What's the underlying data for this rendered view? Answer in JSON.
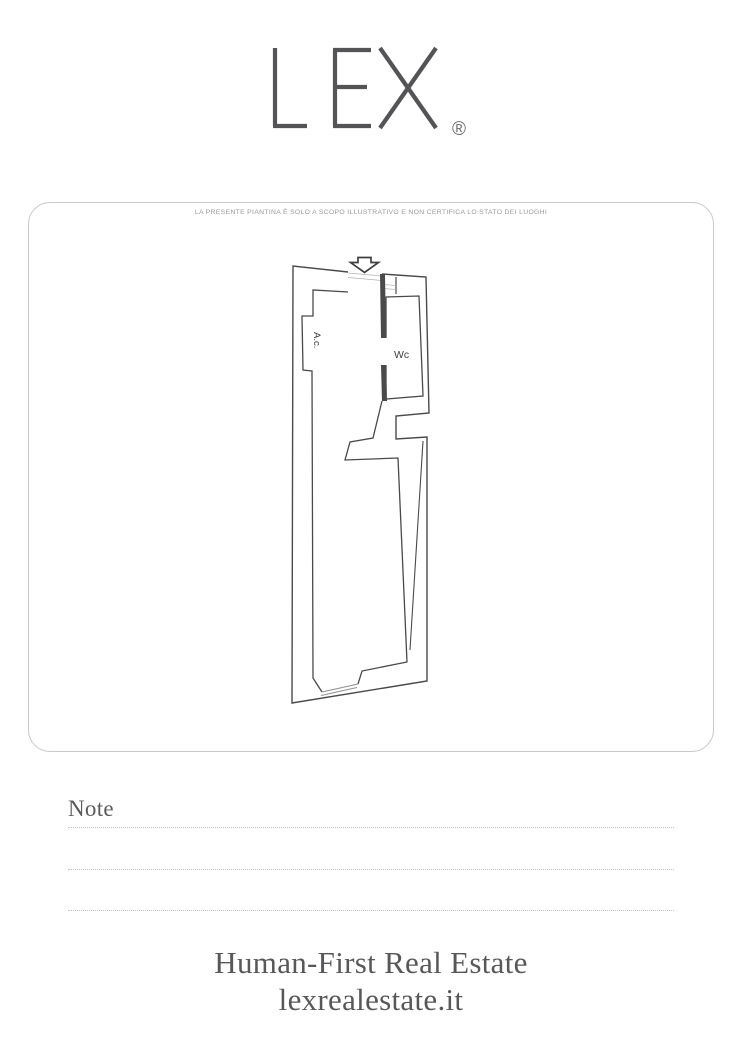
{
  "logo": {
    "text": "LEX",
    "registered": "®"
  },
  "plan_card": {
    "disclaimer": "LA PRESENTE PIANTINA È SOLO A SCOPO ILLUSTRATIVO E NON CERTIFICA LO STATO DEI LUOGHI",
    "floorplan": {
      "type": "floor-plan",
      "rooms": [
        {
          "id": "ac",
          "label": "A.c."
        },
        {
          "id": "wc",
          "label": "Wc"
        }
      ],
      "entrance": "top, marked with downward block arrow",
      "features": [
        "entrance door at top",
        "vent lines near entrance",
        "wall niche on right side",
        "window opening at bottom"
      ]
    }
  },
  "notes_section": {
    "title": "Note",
    "blank_lines": 3
  },
  "footer": {
    "tagline": "Human-First Real Estate",
    "website": "lexrealestate.it"
  },
  "colors": {
    "plan_line": "#4a4a4a",
    "thin_line": "#adadad",
    "muted_text": "#9a9a9a",
    "brand_text": "#58585a",
    "card_border": "#c9c9c9"
  }
}
